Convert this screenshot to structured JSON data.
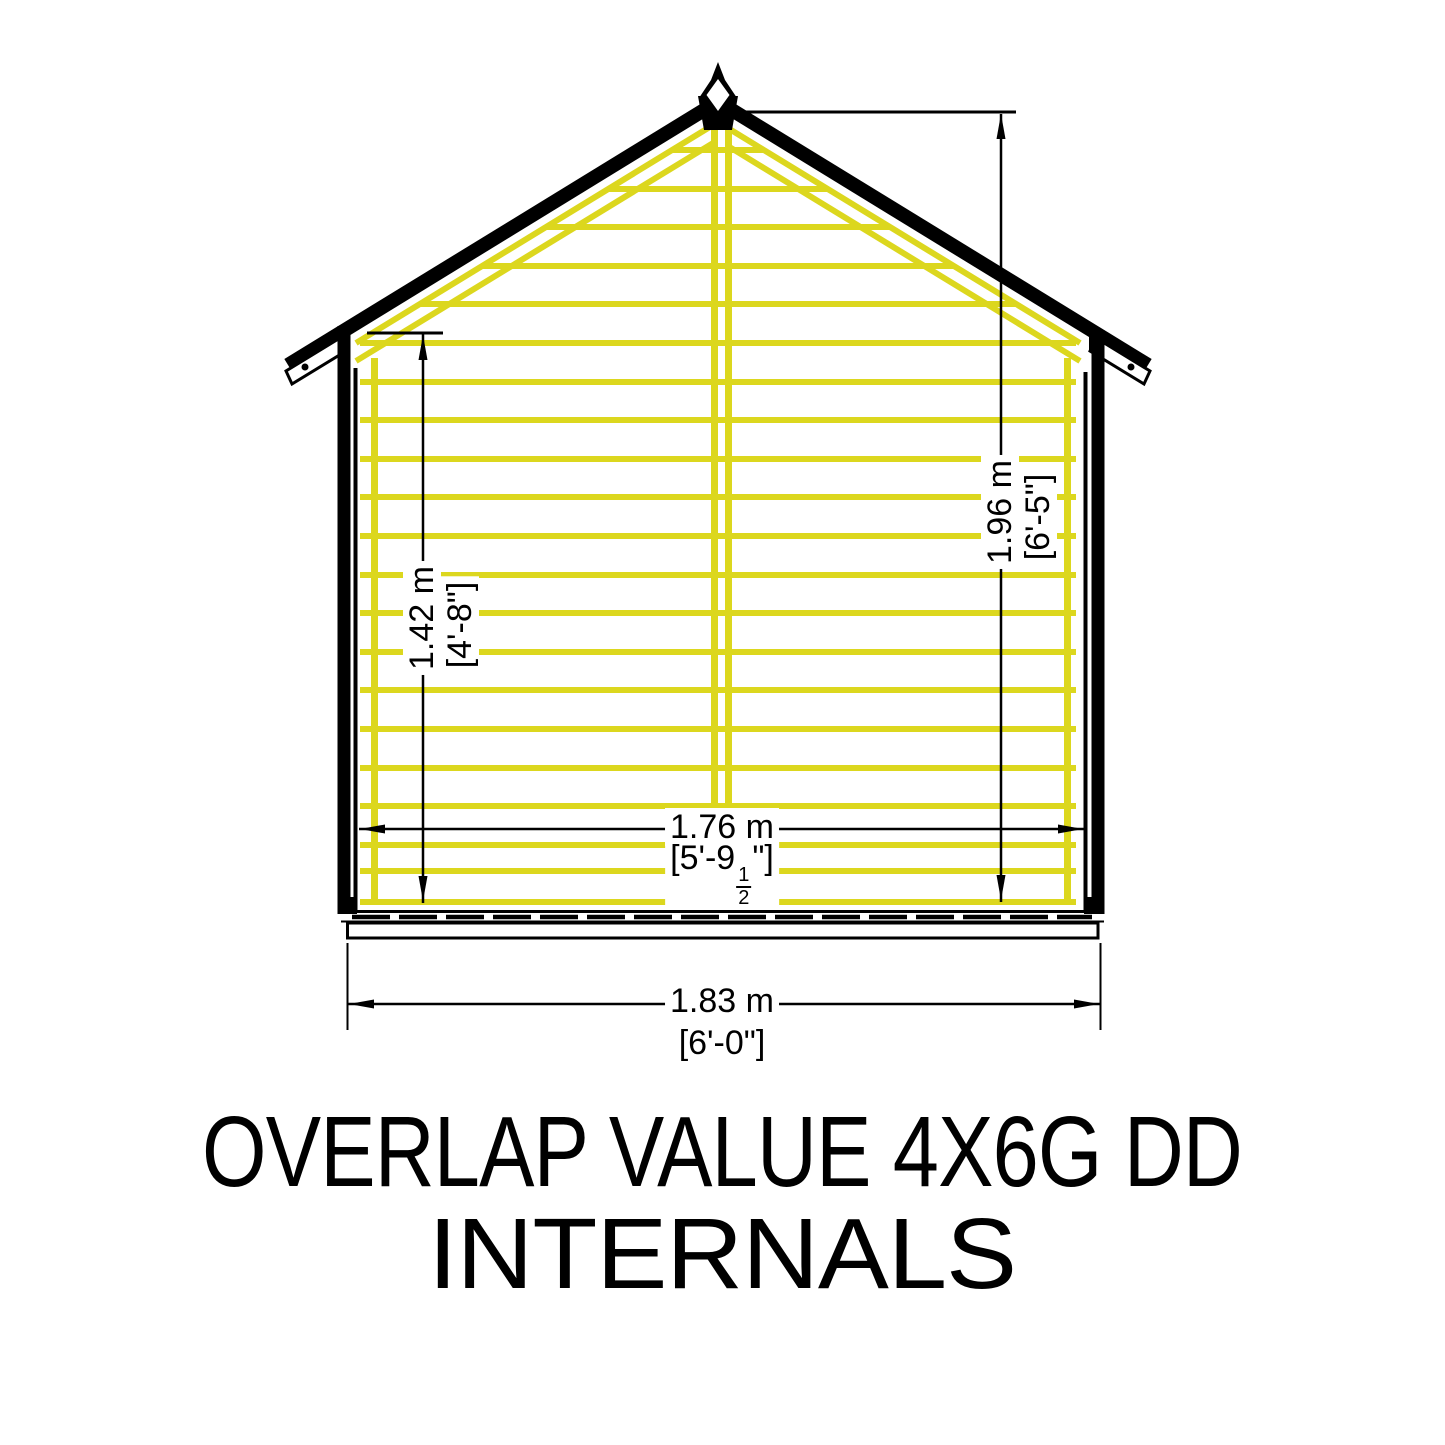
{
  "title": {
    "line1": "OVERLAP VALUE 4X6G DD",
    "line2": "INTERNALS"
  },
  "dimensions": {
    "eaves_height": {
      "metric": "1.42 m",
      "imperial": "[4'-8\"]"
    },
    "ridge_height": {
      "metric": "1.96 m",
      "imperial": "[6'-5\"]"
    },
    "internal_width": {
      "metric": "1.76 m",
      "imperial_prefix": "[5'-9",
      "fraction_numerator": "1",
      "fraction_denominator": "2",
      "imperial_suffix": "\"]"
    },
    "external_width": {
      "metric": "1.83 m",
      "imperial": "[6'-0\"]"
    }
  },
  "colors": {
    "framing_yellow": "#DCD71E",
    "line_black": "#000000",
    "background": "#FFFFFF"
  }
}
